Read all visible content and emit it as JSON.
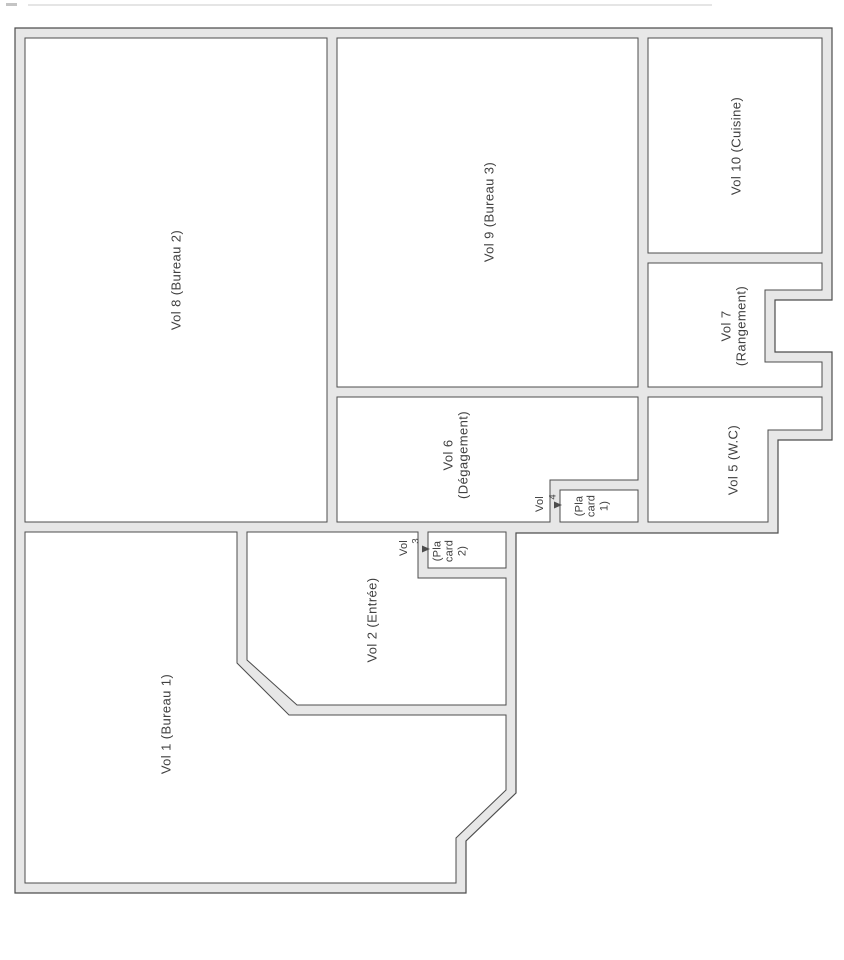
{
  "colors": {
    "background": "#ffffff",
    "wall_fill": "#e7e7e7",
    "wall_line": "#4d4d4d",
    "text": "#404040"
  },
  "rooms": {
    "vol1": {
      "label": "Vol 1 (Bureau 1)"
    },
    "vol2": {
      "label": "Vol 2 (Entrée)"
    },
    "vol5": {
      "label": "Vol 5 (W.C)"
    },
    "vol6": {
      "label": "Vol 6\n(Dégagement)"
    },
    "vol7": {
      "label": "Vol 7 (Rangement)"
    },
    "vol8": {
      "label": "Vol 8 (Bureau 2)"
    },
    "vol9": {
      "label": "Vol 9 (Bureau 3)"
    },
    "vol10": {
      "label": "Vol 10 (Cuisine)"
    }
  },
  "callouts": {
    "vol3": {
      "prefix": "Vol",
      "number": "3",
      "box_label": "(Pla\ncard\n2)"
    },
    "vol4": {
      "prefix": "Vol",
      "number": "4",
      "box_label": "(Pla\ncard\n1)"
    }
  }
}
